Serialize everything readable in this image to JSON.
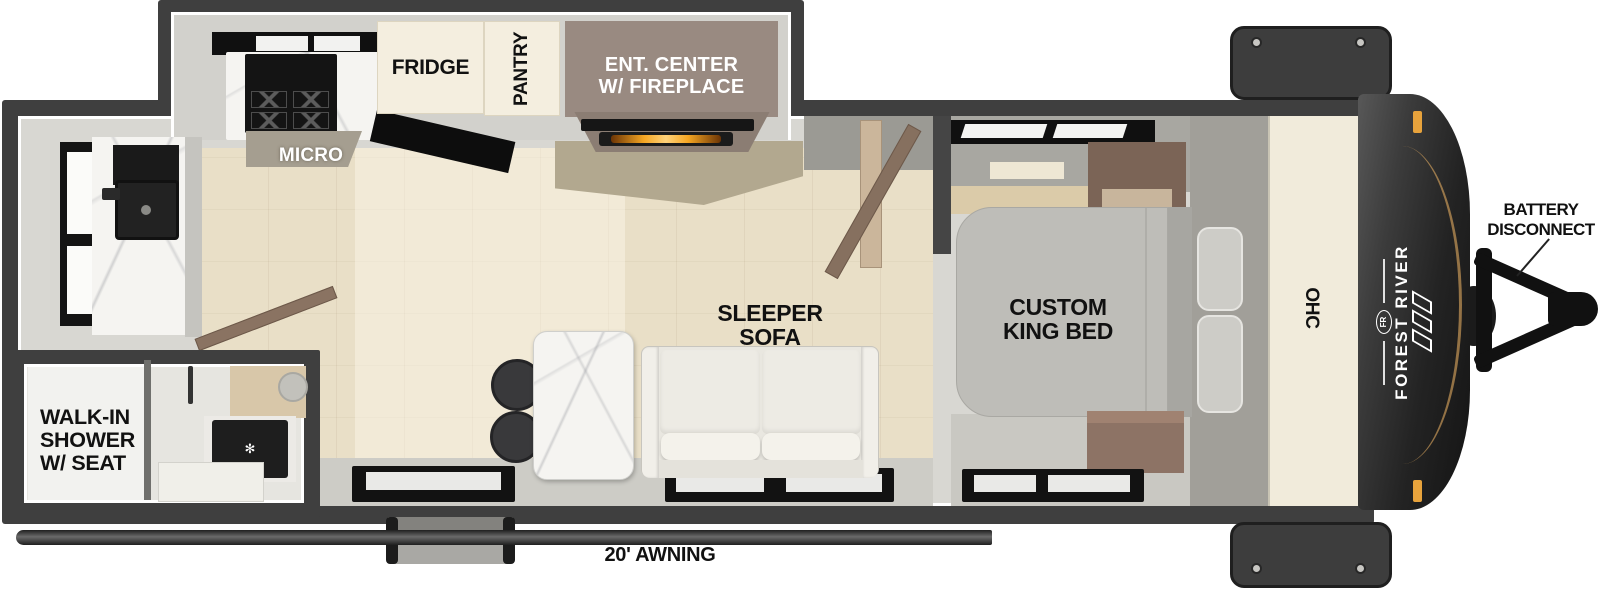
{
  "labels": {
    "fridge": "FRIDGE",
    "pantry": "PANTRY",
    "ent1": "ENT. CENTER",
    "ent2": "W/ FIREPLACE",
    "micro": "MICRO",
    "shower1": "WALK-IN",
    "shower2": "SHOWER",
    "shower3": "W/ SEAT",
    "sofa1": "SLEEPER",
    "sofa2": "SOFA",
    "bed1": "CUSTOM",
    "bed2": "KING BED",
    "ohc": "OHC",
    "brand": "FOREST RIVER",
    "brand_abbr": "FR",
    "battery1": "BATTERY",
    "battery2": "DISCONNECT",
    "awning": "20' AWNING"
  },
  "icons": {
    "drain": "✻"
  },
  "colors": {
    "wall": "#3F3F3F",
    "slide_interior": "#D2D1CC",
    "body_interior": "#D8D7D2",
    "wood_floor": "#E9DFC7",
    "gray_floor": "#CDCCC6",
    "cream_cabinet": "#F1EBDB",
    "ent_center": "#998A81",
    "fireplace_glow": "#F5A623",
    "front_cap": "#1E1E1E",
    "accent_orange": "#E8A33C",
    "bed": "#BEBDB8",
    "sofa": "#E9E7E0",
    "door_wood": "#86705F"
  }
}
